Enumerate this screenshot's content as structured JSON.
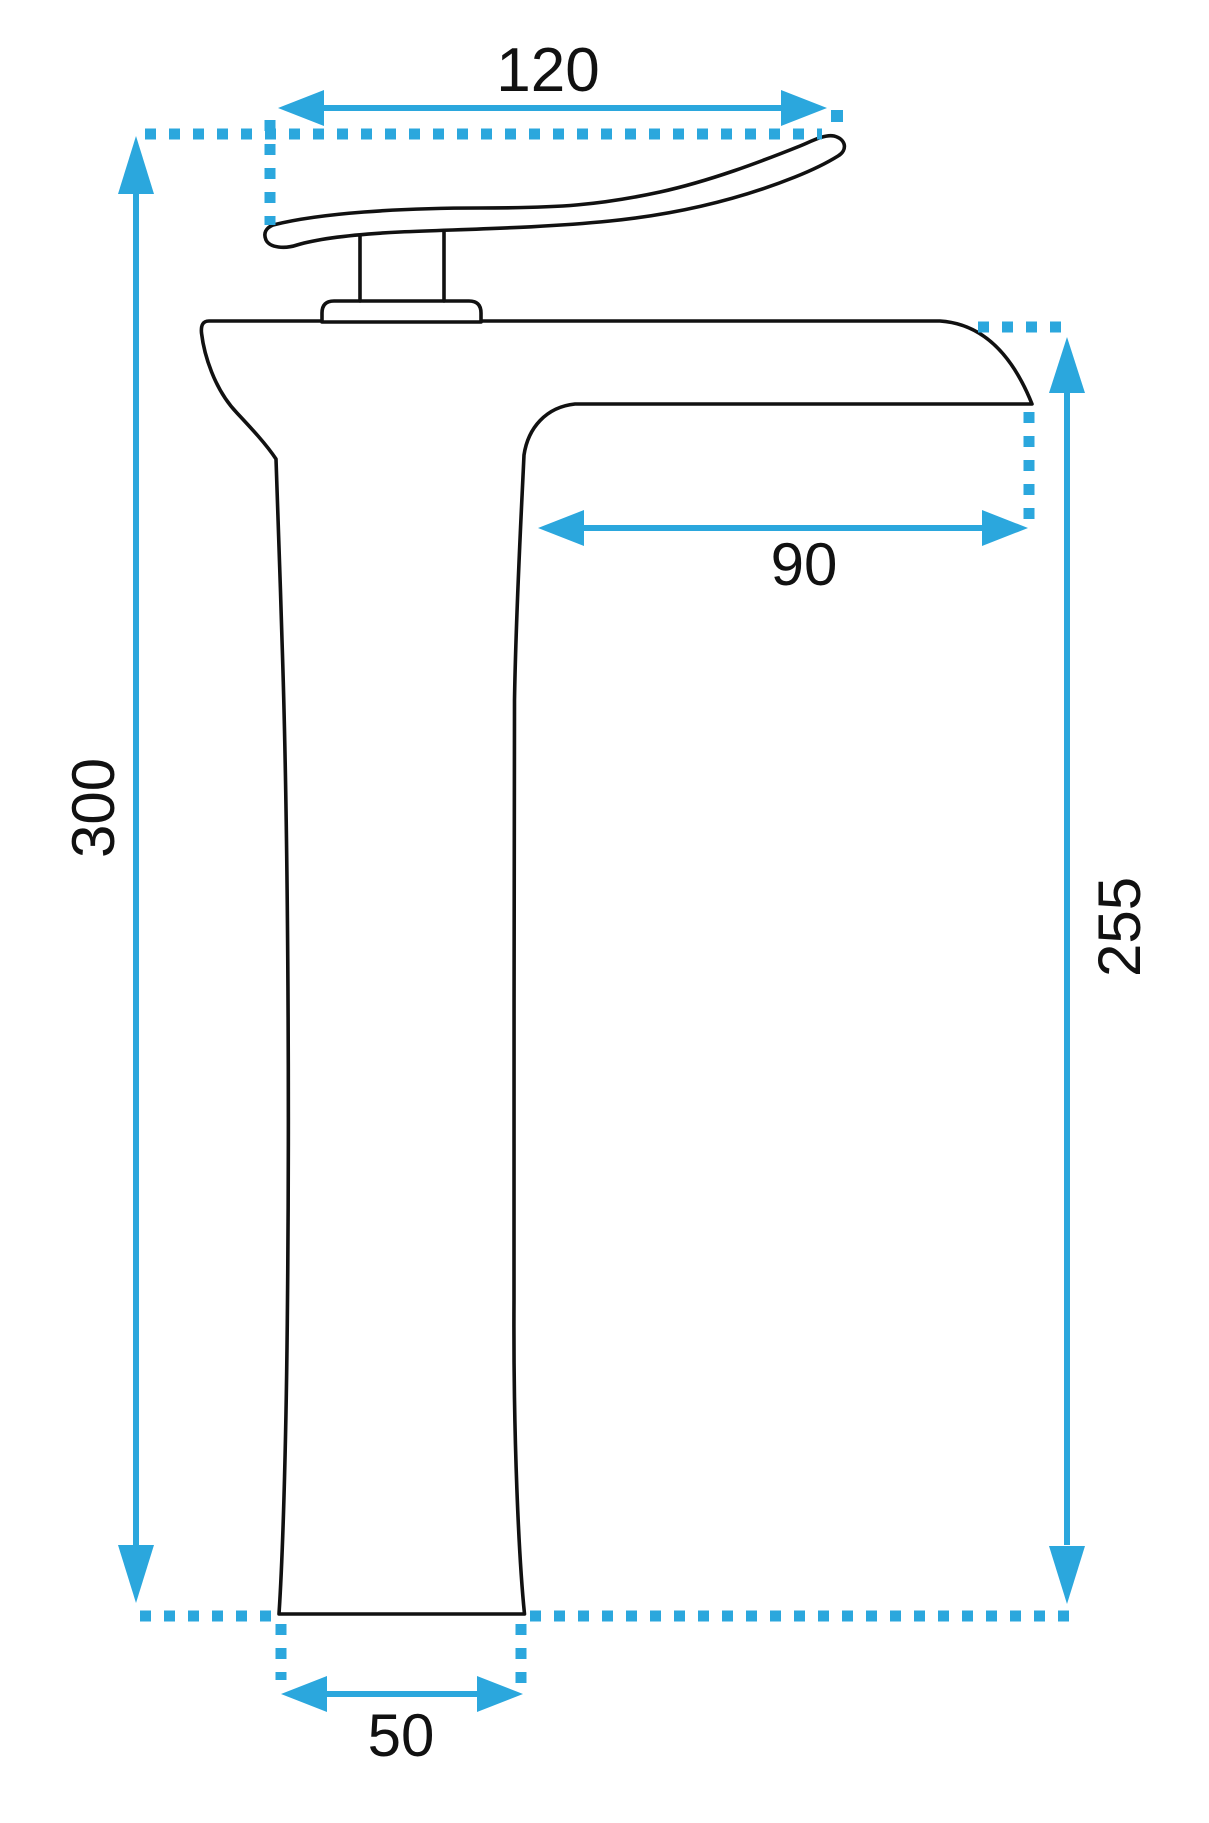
{
  "diagram": {
    "type": "technical-drawing",
    "subject": "tall single-lever waterfall basin faucet, side elevation with dimensions",
    "units": "mm",
    "colors": {
      "dimension_accent": "#2ba7dd",
      "outline": "#111111",
      "background": "#ffffff"
    },
    "dimensions": [
      {
        "id": "handle-span",
        "value": "120",
        "orientation": "horizontal",
        "position": "top"
      },
      {
        "id": "spout-reach",
        "value": "90",
        "orientation": "horizontal",
        "position": "under-spout"
      },
      {
        "id": "total-height",
        "value": "300",
        "orientation": "vertical",
        "position": "left"
      },
      {
        "id": "spout-height",
        "value": "255",
        "orientation": "vertical",
        "position": "right"
      },
      {
        "id": "base-width",
        "value": "50",
        "orientation": "horizontal",
        "position": "bottom"
      }
    ]
  }
}
